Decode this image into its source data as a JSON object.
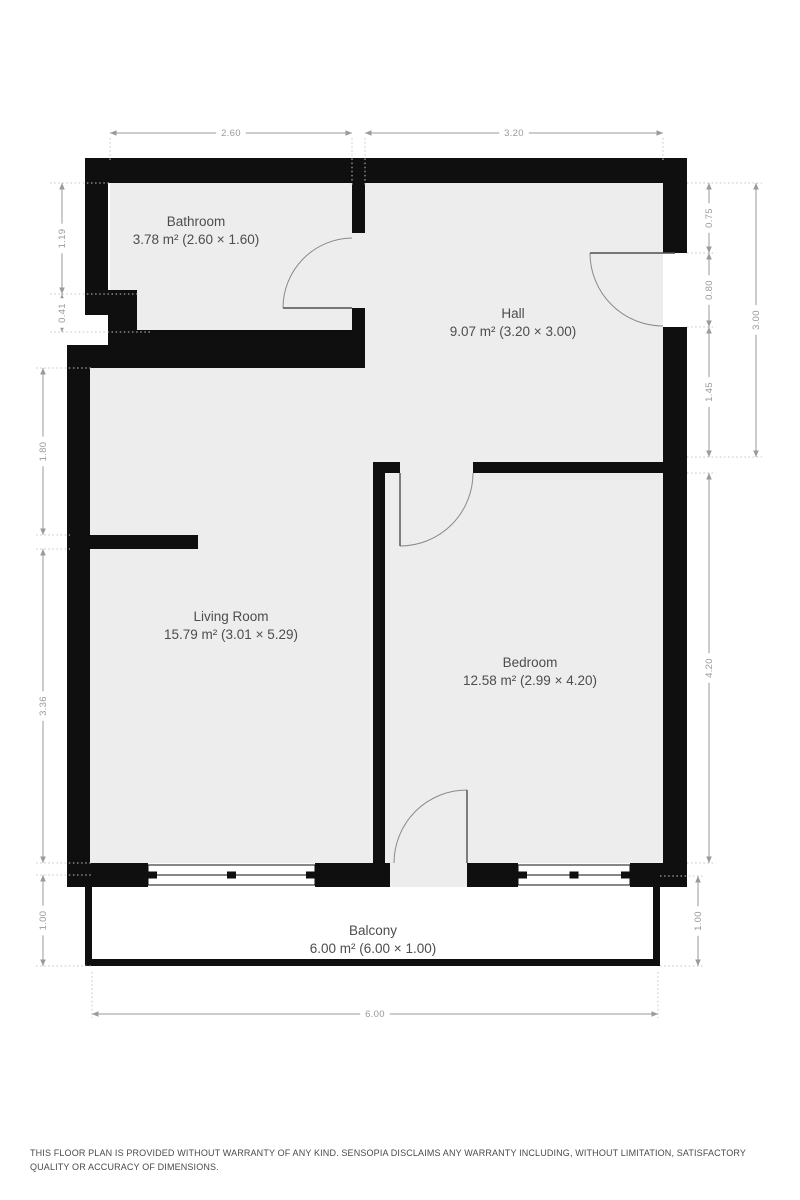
{
  "plan": {
    "colors": {
      "wall": "#0f0f0f",
      "floor": "#ededed",
      "dimension": "#9a9a9a",
      "label": "#4d4d4d",
      "background": "#ffffff"
    },
    "rooms": [
      {
        "id": "bathroom",
        "name": "Bathroom",
        "area": "3.78 m² (2.60 × 1.60)"
      },
      {
        "id": "hall",
        "name": "Hall",
        "area": "9.07 m² (3.20 × 3.00)"
      },
      {
        "id": "living-room",
        "name": "Living Room",
        "area": "15.79 m² (3.01 × 5.29)"
      },
      {
        "id": "bedroom",
        "name": "Bedroom",
        "area": "12.58 m² (2.99 × 4.20)"
      },
      {
        "id": "balcony",
        "name": "Balcony",
        "area": "6.00 m² (6.00 × 1.00)"
      }
    ],
    "dimensions": [
      {
        "label": "2.60",
        "orient": "h",
        "x1": 110,
        "x2": 352,
        "y": 133
      },
      {
        "label": "3.20",
        "orient": "h",
        "x1": 365,
        "x2": 663,
        "y": 133
      },
      {
        "label": "6.00",
        "orient": "h",
        "x1": 92,
        "x2": 658,
        "y": 1014
      },
      {
        "label": "1.19",
        "orient": "v",
        "x": 62,
        "y1": 183,
        "y2": 294
      },
      {
        "label": "0.41",
        "orient": "v",
        "x": 62,
        "y1": 294,
        "y2": 332
      },
      {
        "label": "1.80",
        "orient": "v",
        "x": 43,
        "y1": 368,
        "y2": 535
      },
      {
        "label": "3.36",
        "orient": "v",
        "x": 43,
        "y1": 549,
        "y2": 863
      },
      {
        "label": "1.00",
        "orient": "v",
        "x": 43,
        "y1": 875,
        "y2": 966
      },
      {
        "label": "0.75",
        "orient": "v",
        "x": 709,
        "y1": 183,
        "y2": 253
      },
      {
        "label": "0.80",
        "orient": "v",
        "x": 709,
        "y1": 253,
        "y2": 327
      },
      {
        "label": "1.45",
        "orient": "v",
        "x": 709,
        "y1": 327,
        "y2": 457
      },
      {
        "label": "3.00",
        "orient": "v",
        "x": 756,
        "y1": 183,
        "y2": 457
      },
      {
        "label": "4.20",
        "orient": "v",
        "x": 709,
        "y1": 473,
        "y2": 863
      },
      {
        "label": "1.00",
        "orient": "v",
        "x": 698,
        "y1": 876,
        "y2": 966
      }
    ],
    "extensions": [
      {
        "x1": 110,
        "y1": 138,
        "x2": 110,
        "y2": 160
      },
      {
        "x1": 352,
        "y1": 138,
        "x2": 352,
        "y2": 186
      },
      {
        "x1": 365,
        "y1": 138,
        "x2": 365,
        "y2": 186
      },
      {
        "x1": 663,
        "y1": 138,
        "x2": 663,
        "y2": 160
      },
      {
        "x1": 50,
        "y1": 183,
        "x2": 110,
        "y2": 183
      },
      {
        "x1": 50,
        "y1": 294,
        "x2": 140,
        "y2": 294
      },
      {
        "x1": 50,
        "y1": 332,
        "x2": 150,
        "y2": 332
      },
      {
        "x1": 36,
        "y1": 368,
        "x2": 92,
        "y2": 368
      },
      {
        "x1": 36,
        "y1": 535,
        "x2": 70,
        "y2": 535
      },
      {
        "x1": 36,
        "y1": 549,
        "x2": 70,
        "y2": 549
      },
      {
        "x1": 36,
        "y1": 863,
        "x2": 92,
        "y2": 863
      },
      {
        "x1": 36,
        "y1": 875,
        "x2": 92,
        "y2": 875
      },
      {
        "x1": 36,
        "y1": 966,
        "x2": 92,
        "y2": 966
      },
      {
        "x1": 687,
        "y1": 183,
        "x2": 762,
        "y2": 183
      },
      {
        "x1": 687,
        "y1": 253,
        "x2": 716,
        "y2": 253
      },
      {
        "x1": 687,
        "y1": 327,
        "x2": 716,
        "y2": 327
      },
      {
        "x1": 687,
        "y1": 457,
        "x2": 762,
        "y2": 457
      },
      {
        "x1": 687,
        "y1": 473,
        "x2": 716,
        "y2": 473
      },
      {
        "x1": 687,
        "y1": 863,
        "x2": 716,
        "y2": 863
      },
      {
        "x1": 660,
        "y1": 876,
        "x2": 705,
        "y2": 876
      },
      {
        "x1": 660,
        "y1": 966,
        "x2": 705,
        "y2": 966
      },
      {
        "x1": 92,
        "y1": 972,
        "x2": 92,
        "y2": 1018
      },
      {
        "x1": 658,
        "y1": 972,
        "x2": 658,
        "y2": 1018
      }
    ]
  },
  "footer": {
    "disclaimer": "THIS FLOOR PLAN IS PROVIDED WITHOUT WARRANTY OF ANY KIND. SENSOPIA DISCLAIMS ANY WARRANTY INCLUDING, WITHOUT LIMITATION, SATISFACTORY QUALITY OR ACCURACY OF DIMENSIONS."
  }
}
